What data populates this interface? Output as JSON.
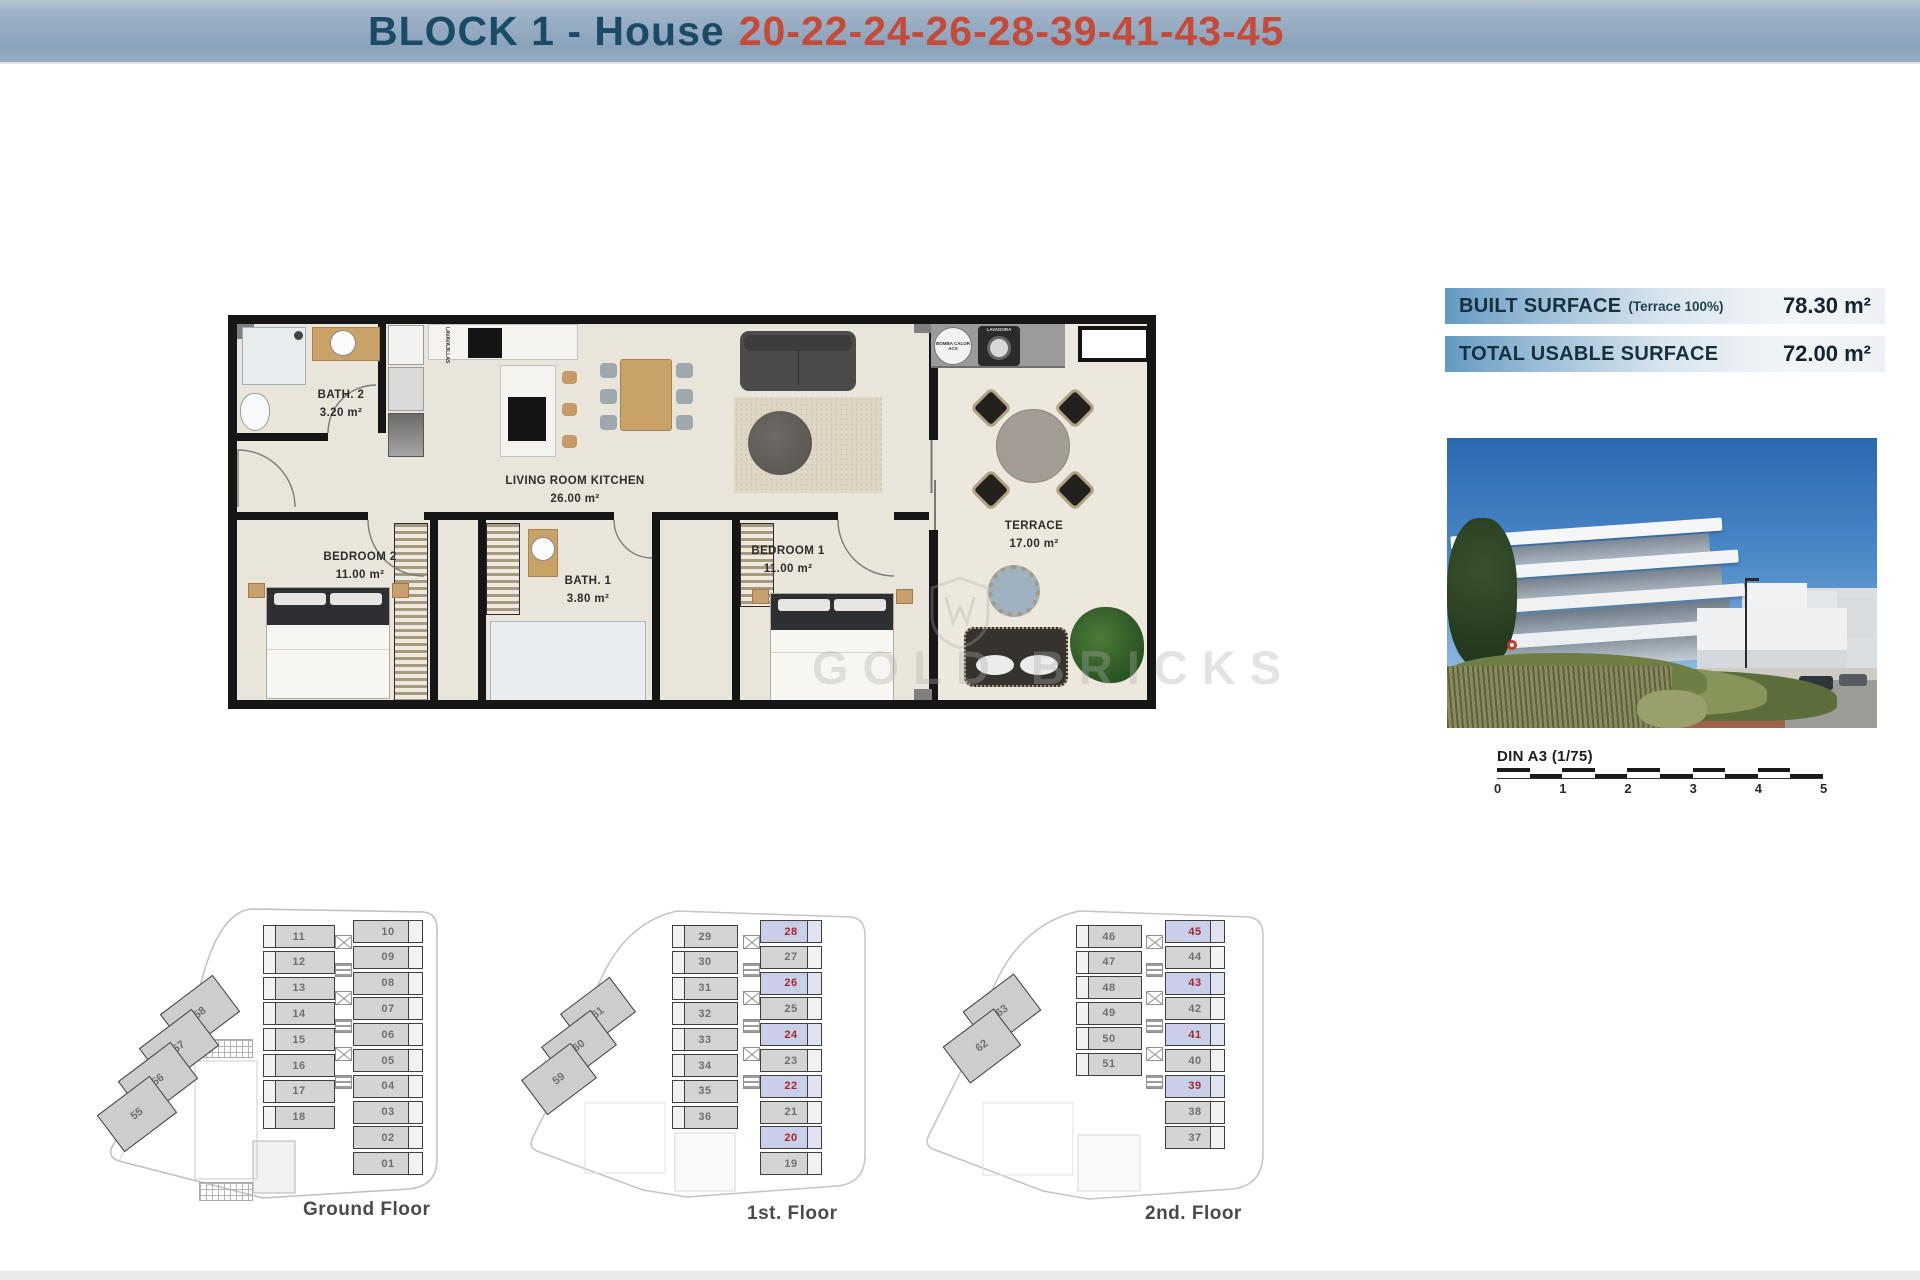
{
  "header": {
    "title_prefix": "BLOCK 1 - House",
    "title_numbers": "20-22-24-26-28-39-41-43-45"
  },
  "apartment_plan": {
    "rooms": [
      {
        "name": "BATH. 2",
        "area": "3.20 m²"
      },
      {
        "name": "BEDROOM 2",
        "area": "11.00 m²"
      },
      {
        "name": "LIVING ROOM KITCHEN",
        "area": "26.00 m²"
      },
      {
        "name": "BATH. 1",
        "area": "3.80 m²"
      },
      {
        "name": "BEDROOM 1",
        "area": "11.00 m²"
      },
      {
        "name": "TERRACE",
        "area": "17.00 m²"
      }
    ],
    "appliances": {
      "dishwasher": "LAVAVAJILLAS",
      "washer": "LAVADORA",
      "heat_pump": "BOMBA CALOR ACS"
    }
  },
  "surface_info": [
    {
      "label": "BUILT SURFACE",
      "note": "(Terrace 100%)",
      "value": "78.30 m²"
    },
    {
      "label": "TOTAL USABLE SURFACE",
      "note": "",
      "value": "72.00 m²"
    }
  ],
  "scale_bar": {
    "label": "DIN A3 (1/75)",
    "ticks": [
      "0",
      "1",
      "2",
      "3",
      "4",
      "5"
    ]
  },
  "floors": [
    {
      "label": "Ground Floor",
      "left_column": [
        "11",
        "12",
        "13",
        "14",
        "15",
        "16",
        "17",
        "18"
      ],
      "right_column": [
        "10",
        "09",
        "08",
        "07",
        "06",
        "05",
        "04",
        "03",
        "02",
        "01"
      ],
      "diagonal": [
        "58",
        "57",
        "56",
        "55"
      ],
      "highlighted": []
    },
    {
      "label": "1st. Floor",
      "left_column": [
        "29",
        "30",
        "31",
        "32",
        "33",
        "34",
        "35",
        "36"
      ],
      "right_column": [
        "28",
        "27",
        "26",
        "25",
        "24",
        "23",
        "22",
        "21",
        "20",
        "19"
      ],
      "diagonal": [
        "61",
        "60",
        "59"
      ],
      "highlighted": [
        "28",
        "26",
        "24",
        "22",
        "20"
      ]
    },
    {
      "label": "2nd. Floor",
      "left_column": [
        "46",
        "47",
        "48",
        "49",
        "50",
        "51"
      ],
      "right_column": [
        "45",
        "44",
        "43",
        "42",
        "41",
        "40",
        "39",
        "38",
        "37"
      ],
      "diagonal": [
        "63",
        "62"
      ],
      "highlighted": [
        "45",
        "43",
        "41",
        "39"
      ]
    }
  ],
  "watermark": {
    "text": "GOLD BRICKS"
  },
  "colors": {
    "header_bg": "#93aabf",
    "title_blue": "#1b4a67",
    "title_red": "#c64a37",
    "highlight_fill": "#c9cfe9",
    "highlight_number": "#a3282c",
    "unit_fill": "#d4d4d4",
    "unit_number": "#6f6f6f"
  }
}
